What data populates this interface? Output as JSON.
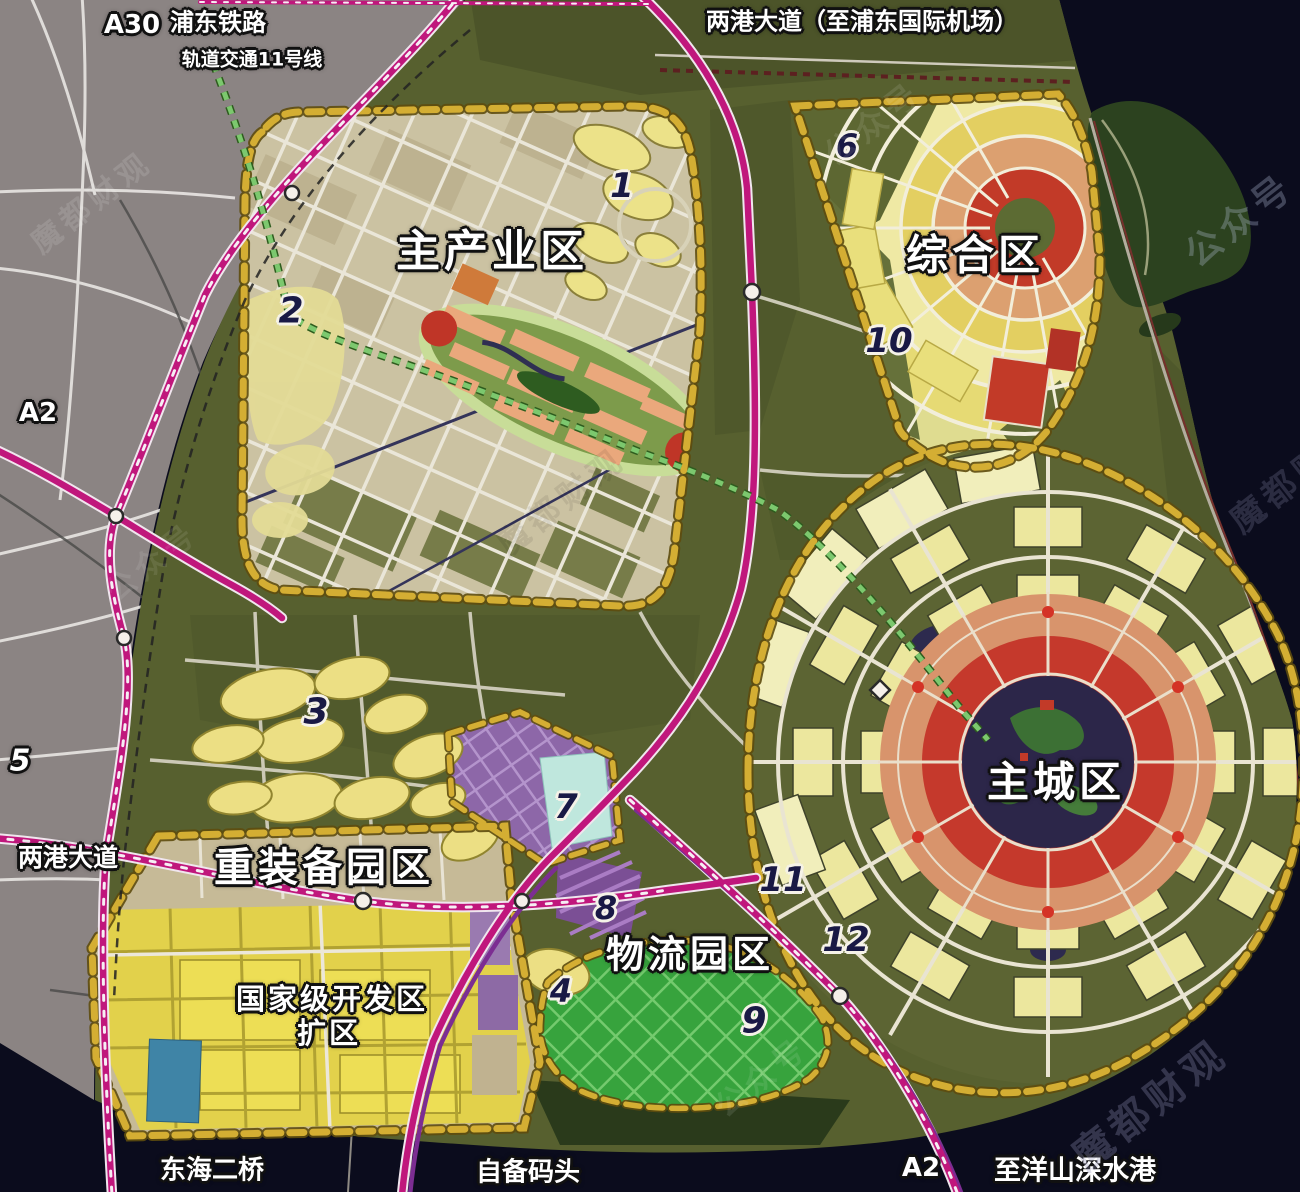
{
  "watermarks": {
    "wechat_label": "公众号",
    "brand": "魔都财观",
    "brand_short": "魔都财"
  },
  "road_labels": {
    "a30": "A30",
    "pudong_railway": "浦东铁路",
    "metro_line_11": "轨道交通11号线",
    "lianggang_airport": "两港大道（至浦东国际机场）",
    "a2_west": "A2",
    "lianggang_west": "两港大道",
    "donghai_bridge_2": "东海二桥",
    "private_wharf": "自备码头",
    "a2_south": "A2",
    "to_yangshan_port": "至洋山深水港"
  },
  "zone_labels": {
    "main_industry": "主产业区",
    "comprehensive": "综合区",
    "main_city": "主城区",
    "heavy_equipment": "重装备园区",
    "national_dev_zone": "国家级开发区",
    "national_dev_zone_line2": "扩区",
    "logistics": "物流园区"
  },
  "markers": [
    "1",
    "2",
    "3",
    "4",
    "5",
    "6",
    "7",
    "8",
    "9",
    "10",
    "11",
    "12"
  ],
  "colors": {
    "highway_magenta": "#c0177c",
    "boundary_gold": "#d4ae33",
    "metro_green": "#7cc86e",
    "sea_dark": "#0b0c1d",
    "urban_gray": "#8b8483",
    "land_olive": "#57602f",
    "industry_beige": "#cbc2a2",
    "dev_yellow": "#e2d14b",
    "logistics_green": "#37a33d",
    "city_ring_red": "#c5392c",
    "city_ring_salmon": "#d8946c",
    "lake_navy": "#2c2649",
    "purple_zone": "#8d67a8"
  }
}
